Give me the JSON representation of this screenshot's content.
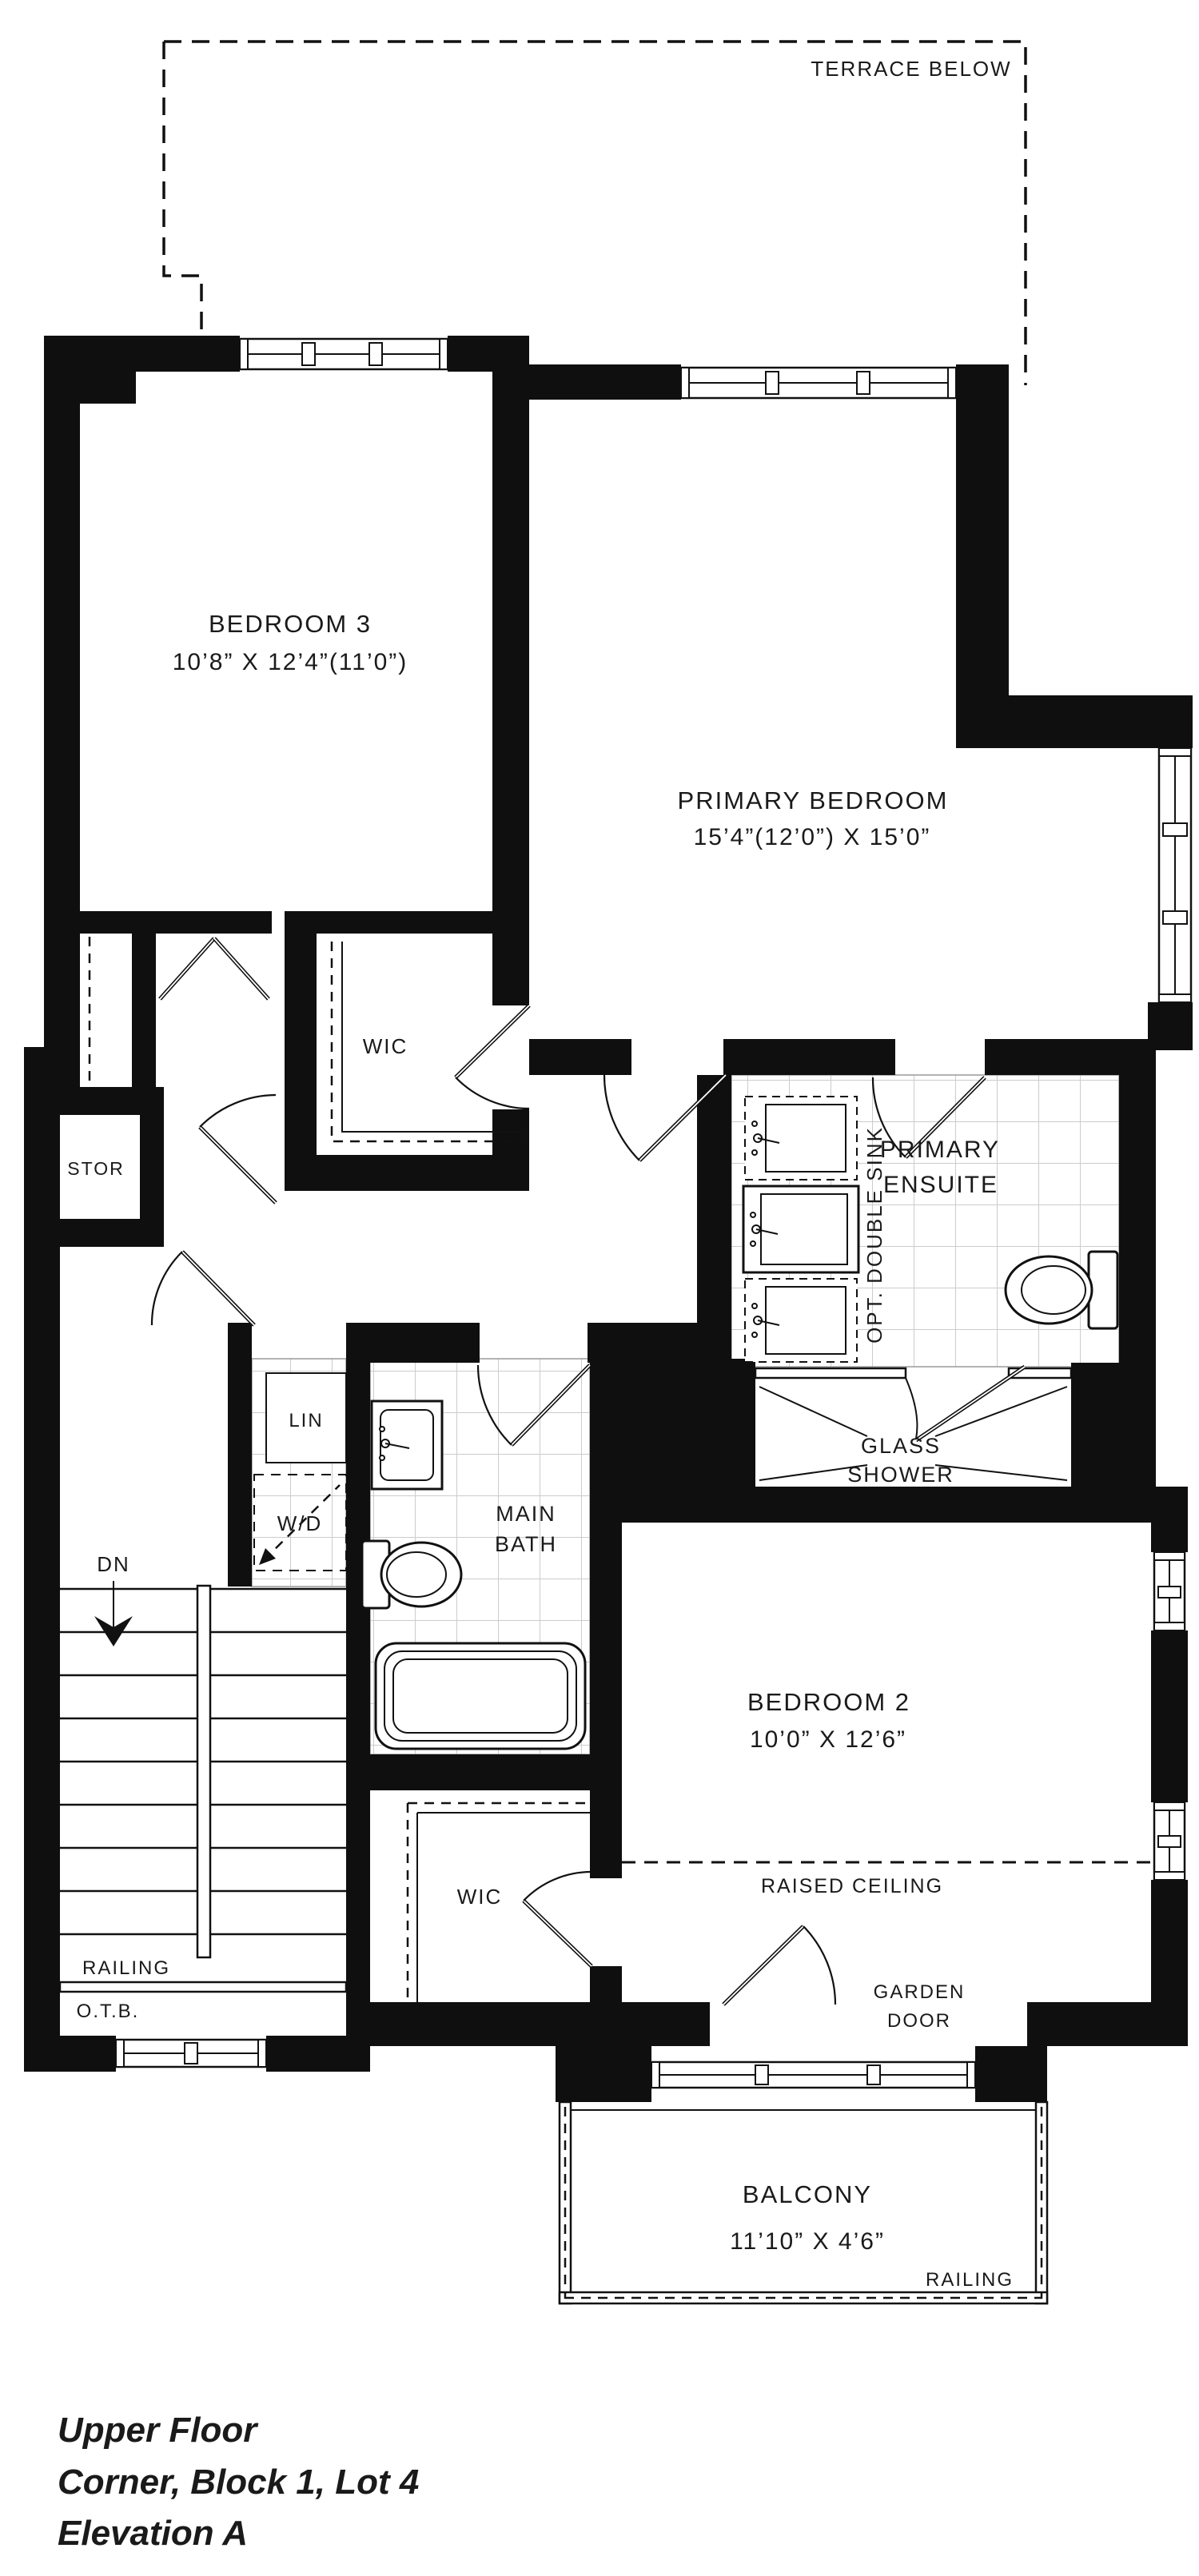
{
  "labels": {
    "terrace": "TERRACE BELOW",
    "bedroom3_name": "BEDROOM 3",
    "bedroom3_dims": "10’8” X 12’4”(11’0”)",
    "primary_name": "PRIMARY BEDROOM",
    "primary_dims": "15’4”(12’0”) X 15’0”",
    "wic_upper": "WIC",
    "stor": "STOR",
    "opt_double_sink": "OPT. DOUBLE SINK",
    "ensuite_line1": "PRIMARY",
    "ensuite_line2": "ENSUITE",
    "glass_line1": "GLASS",
    "glass_line2": "SHOWER",
    "lin": "LIN",
    "wd": "W/D",
    "main_bath_line1": "MAIN",
    "main_bath_line2": "BATH",
    "dn": "DN",
    "bedroom2_name": "BEDROOM 2",
    "bedroom2_dims": "10’0” X 12’6”",
    "raised_ceiling": "RAISED CEILING",
    "garden_line1": "GARDEN",
    "garden_line2": "DOOR",
    "railing_stairs": "RAILING",
    "otb": "O.T.B.",
    "wic_lower": "WIC",
    "balcony_name": "BALCONY",
    "balcony_dims": "11’10” X 4’6”",
    "railing_balcony": "RAILING"
  },
  "footer": {
    "line1": "Upper Floor",
    "line2": "Corner, Block 1, Lot 4",
    "line3": "Elevation A"
  },
  "colors": {
    "wall": "#0f0f0f",
    "text": "#1a1a1a",
    "accent_text": "#7b3e5f",
    "tile_line": "#cccccc"
  }
}
